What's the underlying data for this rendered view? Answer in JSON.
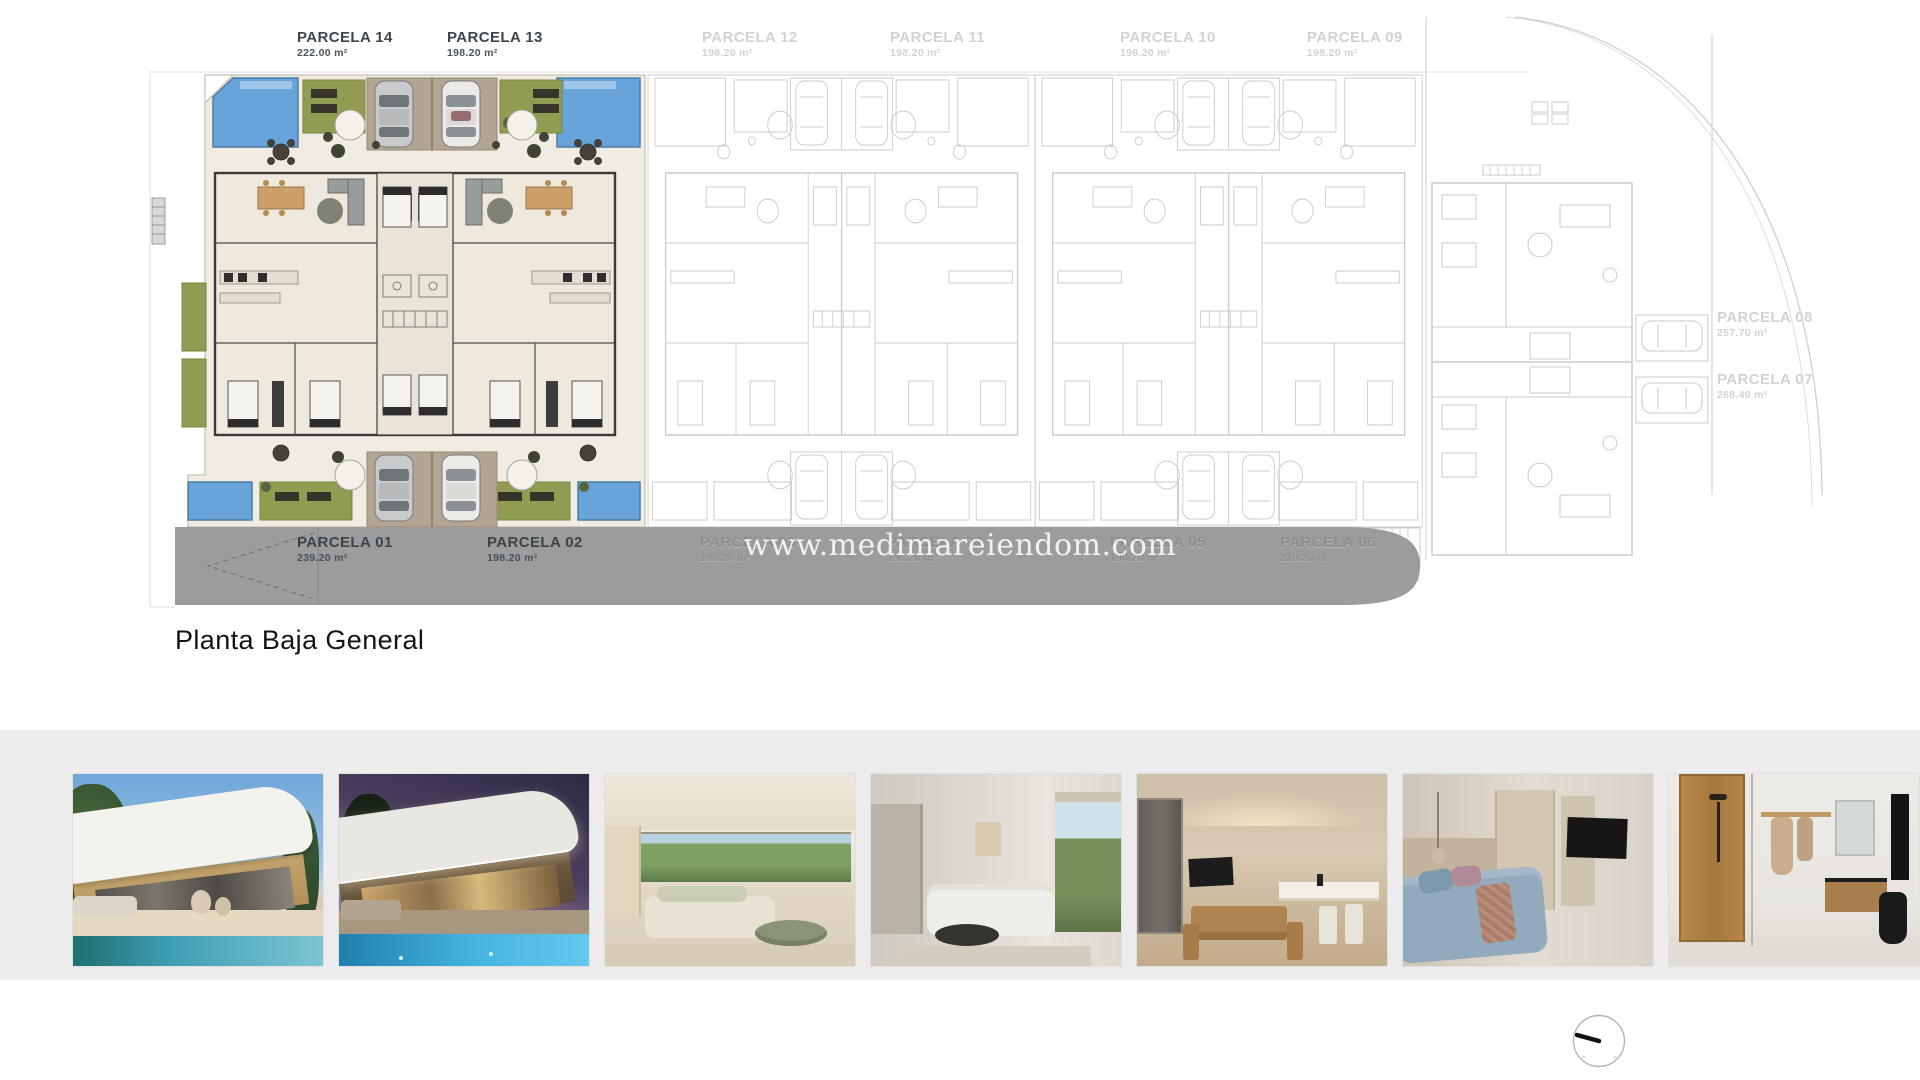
{
  "plan": {
    "title": "Planta Baja General",
    "watermark": "www.medimareiendom.com",
    "top_parcels": [
      {
        "name": "PARCELA 14",
        "area": "222.00 m²"
      },
      {
        "name": "PARCELA 13",
        "area": "198.20 m²"
      },
      {
        "name": "PARCELA 12",
        "area": "198.20 m²"
      },
      {
        "name": "PARCELA 11",
        "area": "198.20 m²"
      },
      {
        "name": "PARCELA 10",
        "area": "198.20 m²"
      },
      {
        "name": "PARCELA 09",
        "area": "198.20 m²"
      }
    ],
    "side_parcels": [
      {
        "name": "PARCELA 08",
        "area": "257.70 m²"
      },
      {
        "name": "PARCELA 07",
        "area": "268.40 m²"
      }
    ],
    "road_parcels": [
      {
        "name": "PARCELA 01",
        "area": "239.20 m²"
      },
      {
        "name": "PARCELA 02",
        "area": "198.20 m²"
      },
      {
        "name": "PARCELA 03",
        "area": "198.20 m²"
      },
      {
        "name": "PARCELA 04",
        "area": "198.20 m²"
      },
      {
        "name": "PARCELA 05",
        "area": "198.20 m²"
      },
      {
        "name": "PARCELA 06",
        "area": "210.20 m²"
      }
    ],
    "colors": {
      "pool": "#68a4d9",
      "grass": "#8f9c52",
      "driveway": "#b3a593",
      "road": "#9c9c9c",
      "floor": "#f1ece3",
      "outline": "#cbcbcb",
      "wall": "#3a3a3a",
      "label-dark": "#3e464d",
      "label-light": "#d2d2d2"
    }
  },
  "gallery": {
    "photos": [
      {
        "name": "villa-exterior-day"
      },
      {
        "name": "villa-exterior-dusk"
      },
      {
        "name": "living-room-garden-view"
      },
      {
        "name": "living-room-white-sofa"
      },
      {
        "name": "kitchen-dining"
      },
      {
        "name": "bedroom"
      },
      {
        "name": "bathroom"
      }
    ]
  }
}
